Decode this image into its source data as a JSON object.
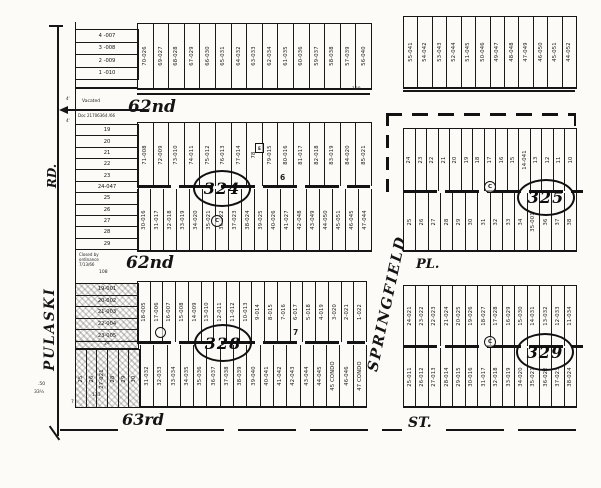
{
  "streets": {
    "west_name": "PULASKI",
    "west_suffix": "RD.",
    "north_label": "62nd",
    "mid_label": "62nd",
    "east_name": "SPRINGFIELD",
    "east_suffix": "PL.",
    "south_name": "63rd",
    "south_suffix": "ST."
  },
  "annotations": {
    "vacated": "Vacated",
    "vacated_doc": "Doc 21706364 /66",
    "closed_line1": "Closed by",
    "closed_line2": "ordinance",
    "closed_line3": "7/13/66",
    "dim_108": "108",
    "dim_128": "128",
    "dim_133": "133",
    "dim_50": ".50",
    "dim_33": "33½",
    "dim_7": "7",
    "tick_4a": "4'",
    "tick_4b": "4'"
  },
  "markers": {
    "c": "C",
    "e": "E"
  },
  "blocks": {
    "north_strip_west": {
      "horizontal_lots": [
        "4 -007",
        "3 -008",
        "2 -009",
        "1 -010"
      ],
      "vertical_lots": [
        "70-026",
        "69-027",
        "68-028",
        "67-029",
        "66-030",
        "65-031",
        "64-032",
        "63-033",
        "62-034",
        "61-035",
        "60-036",
        "59-037",
        "58-038",
        "57-039",
        "56-040"
      ]
    },
    "north_strip_east": {
      "lots": [
        "55-041",
        "54-042",
        "53-043",
        "52-044",
        "51-045",
        "50-046",
        "49-047",
        "48-048",
        "47-049",
        "46-050",
        "45-051",
        "44-052"
      ]
    },
    "block_324": {
      "number": "324",
      "alley_label": "6",
      "west_lots": [
        "19",
        "20",
        "21",
        "22",
        "23",
        "24-047",
        "25",
        "26",
        "27",
        "28",
        "29"
      ],
      "north_lots": [
        "71-008",
        "72-009",
        "73-010",
        "74-011",
        "75-012",
        "76-013",
        "77-014",
        "78",
        "79-015",
        "80-016",
        "81-017",
        "82-018",
        "83-019",
        "84-020",
        "85-021"
      ],
      "south_lots": [
        "30-016",
        "31-017",
        "32-018",
        "33-019",
        "34-020",
        "35-021",
        "36-022",
        "37-023",
        "38-024",
        "39-025",
        "40-026",
        "41-027",
        "42-048",
        "43-049",
        "44-050",
        "45-051",
        "46-045",
        "47-044"
      ]
    },
    "block_325": {
      "number": "325",
      "north_lots": [
        "24",
        "23",
        "22",
        "21",
        "20",
        "19",
        "18",
        "17",
        "16",
        "15",
        "14-041",
        "13",
        "12",
        "11",
        "10"
      ],
      "south_lots": [
        "25",
        "26",
        "27",
        "28",
        "29",
        "30",
        "31",
        "32",
        "33",
        "34",
        "35-001",
        "36",
        "37",
        "38"
      ]
    },
    "block_328": {
      "number": "328",
      "alley_label": "7",
      "west_lots": [
        "19-001",
        "20-002",
        "21-003",
        "22-004",
        "23-005"
      ],
      "west_strip_lot": "24",
      "southwest_lots": [
        "25",
        "26",
        "27-021",
        "28",
        "29",
        "30"
      ],
      "north_lots": [
        "18-005",
        "17-006",
        "16-007",
        "15-008",
        "14-009",
        "13-010",
        "12-011",
        "11-012",
        "10-013",
        "9-014",
        "8-015",
        "7-016",
        "6-017",
        "5-018",
        "4-019",
        "3-020",
        "2-021",
        "1-022"
      ],
      "south_lots": [
        "31-032",
        "32-033",
        "33-034",
        "34-035",
        "35-036",
        "36-037",
        "37-038",
        "38-039",
        "39-040",
        "40-041",
        "41-042",
        "42-043",
        "43-044",
        "44-045",
        "45 CONDO",
        "46-046",
        "47 CONDO"
      ]
    },
    "block_329": {
      "number": "329",
      "north_lots": [
        "24-021",
        "23-022",
        "22-023",
        "21-024",
        "20-025",
        "19-026",
        "18-027",
        "17-028",
        "16-029",
        "15-030",
        "14-031",
        "13-032",
        "12-033",
        "11-034"
      ],
      "south_lots": [
        "25-011",
        "26-012",
        "27-013",
        "28-014",
        "29-015",
        "30-016",
        "31-017",
        "32-018",
        "33-019",
        "34-020",
        "35-021",
        "36-022",
        "37-023",
        "38-024"
      ]
    }
  }
}
